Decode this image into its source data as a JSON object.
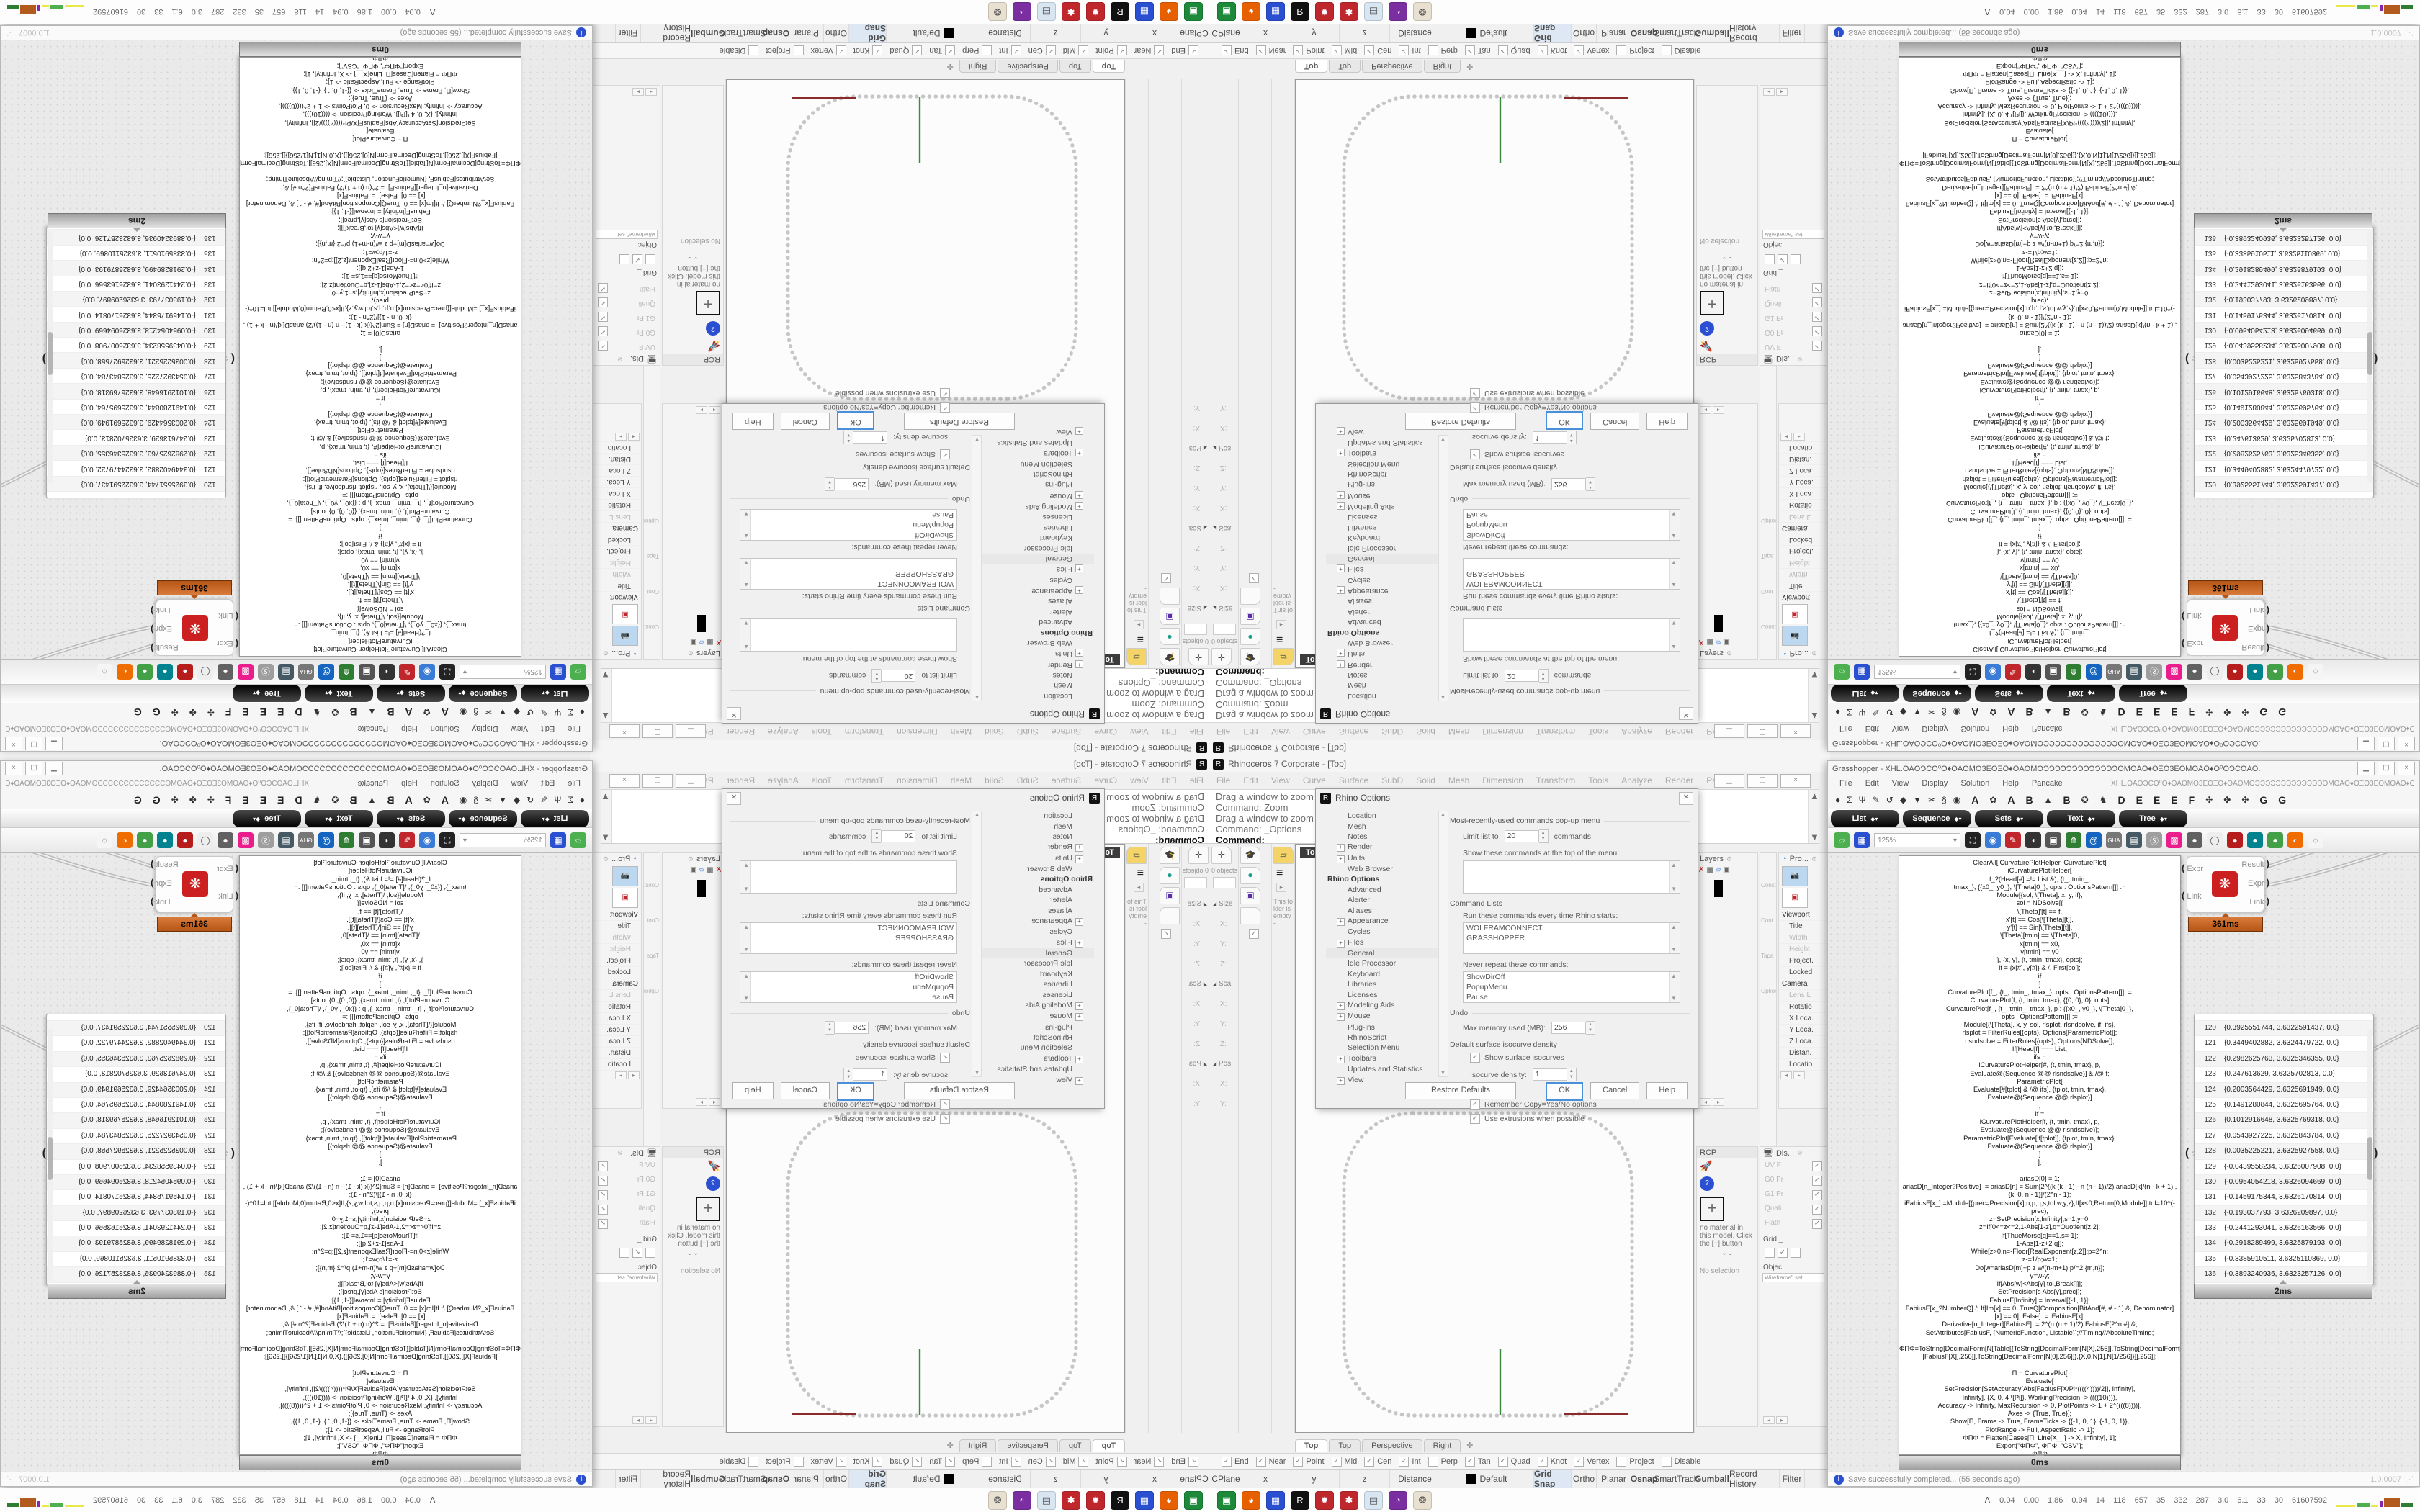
{
  "rhino": {
    "title": "Rhinoceros 7 Corporate - [Top]",
    "app_icon": "R",
    "menu": [
      "File",
      "Edit",
      "View",
      "Curve",
      "Surface",
      "SubD",
      "Solid",
      "Mesh",
      "Dimension",
      "Transform",
      "Tools",
      "Analyze",
      "Render",
      "Panels",
      "Help"
    ],
    "command_history": [
      "Drag a window to zoom (",
      "Command: Zoom",
      "Drag a window to zoom (",
      "Command: _Options"
    ],
    "command_prompt": "Command:",
    "viewport_label": "Top",
    "viewport_tabs": [
      "Top",
      "Top",
      "Perspective",
      "Right"
    ],
    "viewport_tab_add": "✛",
    "left_panels": {
      "box_edit_tab_icon": "✛",
      "objects_count": "0 objects",
      "groups": [
        {
          "label": "Size",
          "fields": [
            "X:",
            "Y:",
            "Z:"
          ]
        },
        {
          "label": "Sca",
          "fields": [
            "X:",
            "Y:",
            "Z:"
          ]
        },
        {
          "label": "Pos",
          "fields": [
            "X:",
            "Y:"
          ]
        }
      ],
      "mid_tabs": [
        "🎓",
        "●",
        "▣",
        "",
        "✓"
      ],
      "folder_note": "This folder is empty-"
    },
    "right_panels": {
      "layers_title": "Layers",
      "constraints_labels": [
        "Constra",
        "Cont",
        "Tapa",
        "Option"
      ],
      "properties_title": "Pro...",
      "properties_rows": [
        {
          "label": "Viewport",
          "kind": "section"
        },
        {
          "label": "Title"
        },
        {
          "label": "Width",
          "gray": true
        },
        {
          "label": "Height",
          "gray": true
        },
        {
          "label": "Project."
        },
        {
          "label": "Locked"
        },
        {
          "label": "Camera",
          "kind": "section"
        },
        {
          "label": "Lens L",
          "gray": true
        },
        {
          "label": "Rotatio"
        },
        {
          "label": "X Loca."
        },
        {
          "label": "Y Loca."
        },
        {
          "label": "Z Loca."
        },
        {
          "label": "Distan."
        },
        {
          "label": "Locatio"
        }
      ],
      "materials": {
        "tab": "RCP",
        "empty_text": "no material in this model. Click the [+] button",
        "chevrons": "⌄⌄",
        "no_selection": "No selection"
      },
      "display": {
        "title": "Dis...",
        "rows": [
          "UV F",
          "G0 Pr",
          "G1 Pr",
          "Quali",
          "Flatn"
        ],
        "grid_label": "Grid _",
        "objects_label": "Objec",
        "mode_field": "Wireframe\" set"
      }
    },
    "osnap": [
      {
        "label": "End",
        "checked": true
      },
      {
        "label": "Near",
        "checked": true
      },
      {
        "label": "Point",
        "checked": true
      },
      {
        "label": "Mid",
        "checked": true
      },
      {
        "label": "Cen",
        "checked": true
      },
      {
        "label": "Int",
        "checked": true
      },
      {
        "label": "Perp",
        "checked": false
      },
      {
        "label": "Tan",
        "checked": true
      },
      {
        "label": "Quad",
        "checked": true
      },
      {
        "label": "Knot",
        "checked": true
      },
      {
        "label": "Vertex",
        "checked": true
      },
      {
        "label": "Project",
        "checked": false
      },
      {
        "label": "Disable",
        "checked": false
      }
    ],
    "status": [
      {
        "label": "CPlane",
        "w": 45
      },
      {
        "label": "x",
        "w": 65
      },
      {
        "label": "y",
        "w": 70
      },
      {
        "label": "z",
        "w": 70
      },
      {
        "label": "Distance",
        "w": 70
      },
      {
        "label": "Default",
        "w": 130,
        "swatch": true
      },
      {
        "label": "Grid Snap",
        "w": 52,
        "hl": true
      },
      {
        "label": "Ortho",
        "w": 35
      },
      {
        "label": "Planar",
        "w": 48
      },
      {
        "label": "Osnap",
        "w": 36,
        "bold": true
      },
      {
        "label": "SmartTrack",
        "w": 53
      },
      {
        "label": "Gumball",
        "w": 47,
        "bold": true
      },
      {
        "label": "Record History",
        "w": 70
      },
      {
        "label": "Filter",
        "w": 35
      }
    ],
    "options_dialog": {
      "title": "Rhino Options",
      "tree": [
        {
          "label": "Location"
        },
        {
          "label": "Mesh"
        },
        {
          "label": "Notes"
        },
        {
          "label": "Render",
          "plus": true
        },
        {
          "label": "Units",
          "plus": true
        },
        {
          "label": "Web Browser"
        },
        {
          "label": "Rhino Options",
          "root": true
        },
        {
          "label": "Advanced"
        },
        {
          "label": "Alerter"
        },
        {
          "label": "Aliases"
        },
        {
          "label": "Appearance",
          "plus": true
        },
        {
          "label": "Cycles"
        },
        {
          "label": "Files",
          "plus": true
        },
        {
          "label": "General",
          "sel": true
        },
        {
          "label": "Idle Processor"
        },
        {
          "label": "Keyboard"
        },
        {
          "label": "Libraries"
        },
        {
          "label": "Licenses"
        },
        {
          "label": "Modeling Aids",
          "plus": true
        },
        {
          "label": "Mouse",
          "plus": true
        },
        {
          "label": "Plug-ins"
        },
        {
          "label": "RhinoScript"
        },
        {
          "label": "Selection Menu"
        },
        {
          "label": "Toolbars",
          "plus": true
        },
        {
          "label": "Updates and Statistics"
        },
        {
          "label": "View",
          "plus": true
        }
      ],
      "mru_title": "Most-recently-used commands pop-up menu",
      "limit_label": "Limit list to",
      "limit_value": "20",
      "limit_suffix": "commands",
      "show_label": "Show these commands at the top of the menu:",
      "cmdlists_title": "Command Lists",
      "run_label": "Run these commands every time Rhino starts:",
      "run_items": [
        "WOLFRAMCONNECT",
        "GRASSHOPPER"
      ],
      "never_label": "Never repeat these commands:",
      "never_items": [
        "ShowDirOff",
        "PopupMenu",
        "Pause"
      ],
      "undo_title": "Undo",
      "undo_label": "Max memory used (MB):",
      "undo_value": "256",
      "iso_title": "Default surface isocurve density",
      "iso_checkbox": "Show surface isocurves",
      "density_label": "Isocurve density:",
      "density_value": "1",
      "behavior_title": "Command behavior",
      "behavior_cb1": "Remember Copy=Yes/No options",
      "behavior_cb2": "Use extrusions when possible",
      "buttons": [
        "Restore Defaults",
        "OK",
        "Cancel",
        "Help"
      ]
    }
  },
  "grasshopper": {
    "title": "Grasshopper - XHL.OAOƆCO⁰O♦OAOMO3EOΞO♦OAOMOƆƆƆƆƆƆƆƆƆƆƆƆƆOMOAO♦OΞO3EOMOAO♦O⁰OƆCOAO.",
    "menu": [
      "File",
      "Edit",
      "View",
      "Display",
      "Solution",
      "Help",
      "Pancake"
    ],
    "doc_label": "XHL.OAOƆCO⁰O♦OAOMO3EOΞO♦OAOMOƆƆƆƆƆƆƆƆƆƆƆƆƆOMOAO♦OΞO3EOMOAO♦O⁰OƆCOAO.",
    "ribbon_small": [
      "●",
      "Σ",
      "Ψ",
      "✎",
      "↺",
      "◆",
      "▼",
      "✂",
      "§",
      "◉"
    ],
    "ribbon_tabs": [
      "A",
      "✿",
      "A",
      "B",
      "▲",
      "B",
      "✪",
      "♞",
      "D",
      "E",
      "E",
      "E",
      "F",
      "✢",
      "✤",
      "✣",
      "G",
      "G"
    ],
    "pills": [
      "List",
      "Sequence",
      "Sets",
      "Text",
      "Tree"
    ],
    "zoom_value": "125%",
    "component": {
      "inputs": [
        "Expr",
        "Link"
      ],
      "outputs": [
        "Result",
        "Expr",
        "Link"
      ],
      "badge": "361ms"
    },
    "code_badge": "0ms",
    "table_badge": "2ms",
    "code_lines": [
      "ClearAll[iCurvaturePlotHelper, CurvaturePlot]",
      "iCurvaturePlotHelper[",
      "f_?(Head[#] =!= List &), {t_, tmin_,",
      "tmax_}, {{x0_, y0_}, \\[Theta]0_}, opts : OptionsPattern[]] :=",
      "Module[{sol, \\[Theta], x, y, if},",
      "sol = NDSolve[{",
      "\\[Theta]'[t] == f,",
      "x'[t] == Cos[\\[Theta][t]],",
      "y'[t] == Sin[\\[Theta][t]],",
      "\\[Theta][tmin] == \\[Theta]0,",
      "x[tmin] == x0,",
      "y[tmin] == y0",
      "}, {x, y}, {t, tmin, tmax}, opts];",
      "if = {x[#], y[#]} & /. First[sol];",
      "if",
      "]",
      "CurvaturePlot[f_, {t_, tmin_, tmax_}, opts : OptionsPattern[]] :=",
      "CurvaturePlot[f, {t, tmin, tmax}, {{0, 0}, 0}, opts]",
      "CurvaturePlot[f_, {t_, tmin_, tmax_}, p : {{x0_, y0_}, \\[Theta]0_},",
      "opts : OptionsPattern[]] :=",
      "Module[{\\[Theta], x, y, sol, rlsplot, rlsndsolve, if, ifs},",
      "rlsplot = FilterRules[{opts}, Options[ParametricPlot]];",
      "rlsndsolve = FilterRules[{opts}, Options[NDSolve]];",
      "If[Head[f] === List,",
      "ifs =",
      "iCurvaturePlotHelper[#, {t, tmin, tmax}, p,",
      "Evaluate@(Sequence @@ rlsndsolve)] & /@ f;",
      "ParametricPlot[",
      "Evaluate[#[tplot] & /@ ifs], {tplot, tmin, tmax},",
      "Evaluate@(Sequence @@ rlsplot)]",
      ",",
      "if =",
      "iCurvaturePlotHelper[f, {t, tmin, tmax}, p,",
      "Evaluate@(Sequence @@ rlsndsolve)];",
      "ParametricPlot[Evaluate[if[tplot]], {tplot, tmin, tmax},",
      "Evaluate@(Sequence @@ rlsplot)]",
      "]",
      "];",
      "",
      "ariasD[0] = 1;",
      "ariasD[n_Integer?Positive] := ariasD[n] = Sum[2^((k (k - 1) - n (n - 1))/2) ariasD[k]/(n - k + 1)!,",
      "{k, 0, n - 1}]/(2^n - 1);",
      "iFabiusF[x_]:=Module[{prec=Precision[x],n,p,q,s,tol,w,y,z},If[x<0,Return[0,Module]];tol=10^(-",
      "prec);",
      "z=SetPrecision[x,Infinity];s=1;y=0;",
      "z=If[0<=z<=2,1-Abs[1-z],q=Quotient[z,2];",
      "If[ThueMorse[q]==1,s=-1];",
      "1-Abs[1-z+2 q]];",
      "While[z>0,n=-Floor[RealExponent[z,2]];p=2^n;",
      "z-=1/p;w=1;",
      "Do[w=ariasD[m]+p z w/(n-m+1);p/=2,{m,n}];",
      "y=w-y;",
      "If[Abs[w]<Abs[y] tol,Break[]]];",
      "SetPrecision[s Abs[y],prec]];",
      "FabiusF[Infinity] = Interval[{-1, 1}];",
      "FabiusF[x_?NumberQ] /; If[Im[x] == 0, TrueQ[Composition[BitAnd[#, # - 1] &, Denominator]",
      "[x] == 0], False] := iFabiusF[x];",
      "Derivative[n_Integer][FabiusF] := 2^(n (n + 1)/2) FabiusF[2^n #] &;",
      "SetAttributes[FabiusF, {NumericFunction, Listable}];//Timing//AbsoluteTiming;",
      "",
      "ΦΠΦ=ToString[DecimalForm[N[Table[{ToString[DecimalForm[N[X],256]],ToString[DecimalForm[N",
      "[FabiusF[X]],256]],ToString[DecimalForm[N[0],256]]},{X,0,N[1],N[1/256]}]],256]];",
      "",
      "Π = CurvaturePlot[",
      "Evaluate[",
      "SetPrecision[SetAccuracy[Abs[FabiusF[X/Pi*((((4))))/2]], Infinity],",
      "Infinity], {X, 0, 4 \\[Pi]}, WorkingPrecision -> ((((10)))),",
      "Accuracy -> Infinity, MaxRecursion -> 0, PlotPoints -> 1 + 2^((((8))))],",
      "Axes -> {True, True}];",
      "Show[Π, Frame -> True, FrameTicks -> {{-1, 0, 1}, {-1, 0, 1}},",
      "PlotRange -> Full, AspectRatio -> 1];",
      "ΦΠΦ = Flatten[Cases[Π, Line[X__] -> X, Infinity], 1];",
      "Export[\"ΦΠΦ\", ΦΠΦ, \"CSV\"];",
      "ΦΠΦ"
    ],
    "table_rows": [
      {
        "n": "120",
        "v": "{0.3925551744, 3.6322591437, 0.0}"
      },
      {
        "n": "121",
        "v": "{0.3449402882, 3.6324479722, 0.0}"
      },
      {
        "n": "122",
        "v": "{0.2982625763, 3.6325346355, 0.0}"
      },
      {
        "n": "123",
        "v": "{0.247613629, 3.6325702813, 0.0}"
      },
      {
        "n": "124",
        "v": "{0.2003564429, 3.6325691949, 0.0}"
      },
      {
        "n": "125",
        "v": "{0.1491280844, 3.6325695764, 0.0}"
      },
      {
        "n": "126",
        "v": "{0.1012916648, 3.6325769318, 0.0}"
      },
      {
        "n": "127",
        "v": "{0.0543927225, 3.6325843784, 0.0}"
      },
      {
        "n": "128",
        "v": "{0.0035225221, 3.6325927558, 0.0}"
      },
      {
        "n": "129",
        "v": "{-0.0439558234, 3.6326007908, 0.0}"
      },
      {
        "n": "130",
        "v": "{-0.0954054218, 3.6326094669, 0.0}"
      },
      {
        "n": "131",
        "v": "{-0.1459175344, 3.6326170814, 0.0}"
      },
      {
        "n": "132",
        "v": "{-0.193037793, 3.6326209897, 0.0}"
      },
      {
        "n": "133",
        "v": "{-0.2441293041, 3.6326163566, 0.0}"
      },
      {
        "n": "134",
        "v": "{-0.2918289499, 3.6325879193, 0.0}"
      },
      {
        "n": "135",
        "v": "{-0.3385910511, 3.6325110869, 0.0}"
      },
      {
        "n": "136",
        "v": "{-0.3893240936, 3.6323257126, 0.0}"
      },
      {
        "n": "137",
        "v": "{-0.4366640544, 3.6319882257, 0.0}"
      }
    ],
    "toast": "Save successfully completed... (55 seconds ago)",
    "version": "1.0.0007"
  },
  "taskbar": {
    "expand": "ᐱ",
    "stats": [
      "0.04",
      "0.00",
      "1.86",
      "0.94",
      "14",
      "118",
      "657",
      "35",
      "332",
      "287",
      "3.0",
      "6.1",
      "33",
      "30",
      "61607592"
    ],
    "icons": [
      {
        "bg": "#1d8a3a",
        "glyph": "▣"
      },
      {
        "bg": "#e66000",
        "glyph": "◕"
      },
      {
        "bg": "#2a4fd0",
        "glyph": "▦"
      },
      {
        "bg": "#111111",
        "glyph": "R"
      },
      {
        "bg": "#c0272d",
        "glyph": "✹"
      },
      {
        "bg": "#c0272d",
        "glyph": "✱"
      },
      {
        "bg": "#d8e6f2",
        "glyph": "▤"
      },
      {
        "bg": "#7a2ea0",
        "glyph": "◔"
      },
      {
        "bg": "#e8e0d0",
        "glyph": "❂"
      }
    ]
  },
  "gh_toolbar_icons": [
    {
      "bg": "#4caf50",
      "glyph": "▱"
    },
    {
      "bg": "#2a4fd0",
      "glyph": "▦"
    },
    {
      "bg": "zoom"
    },
    {
      "bg": "#222222",
      "glyph": "⛶"
    },
    {
      "bg": "#3a7bd5",
      "glyph": "◉"
    },
    {
      "bg": "#c0272d",
      "glyph": "✎"
    },
    {
      "bg": "#333333",
      "glyph": "◖"
    },
    {
      "bg": "#555555",
      "glyph": "▣"
    },
    {
      "bg": "#2e7d32",
      "glyph": "⟰"
    },
    {
      "bg": "#1565c0",
      "glyph": "@"
    },
    {
      "bg": "#777777",
      "glyph": "GHA"
    },
    {
      "bg": "#455a64",
      "glyph": "▤"
    },
    {
      "bg": "#9e9e9e",
      "glyph": "Ⓢ"
    },
    {
      "bg": "#e91e8c",
      "glyph": "▩"
    },
    {
      "bg": "#616161",
      "glyph": "●"
    },
    {
      "bg": "#eeeeee",
      "glyph": "◯"
    },
    {
      "bg": "#b71c1c",
      "glyph": "●"
    },
    {
      "bg": "#00838f",
      "glyph": "●"
    },
    {
      "bg": "#43a047",
      "glyph": "●"
    },
    {
      "bg": "#ef6c00",
      "glyph": "◐"
    },
    {
      "bg": "#f5f5f5",
      "glyph": "◌"
    }
  ],
  "colors": {
    "curve_dots": "#c6c6c6",
    "green_marker": "#3f8a3f",
    "red_marker": "#8b2a2a",
    "badge_orange": "#c2601e"
  }
}
